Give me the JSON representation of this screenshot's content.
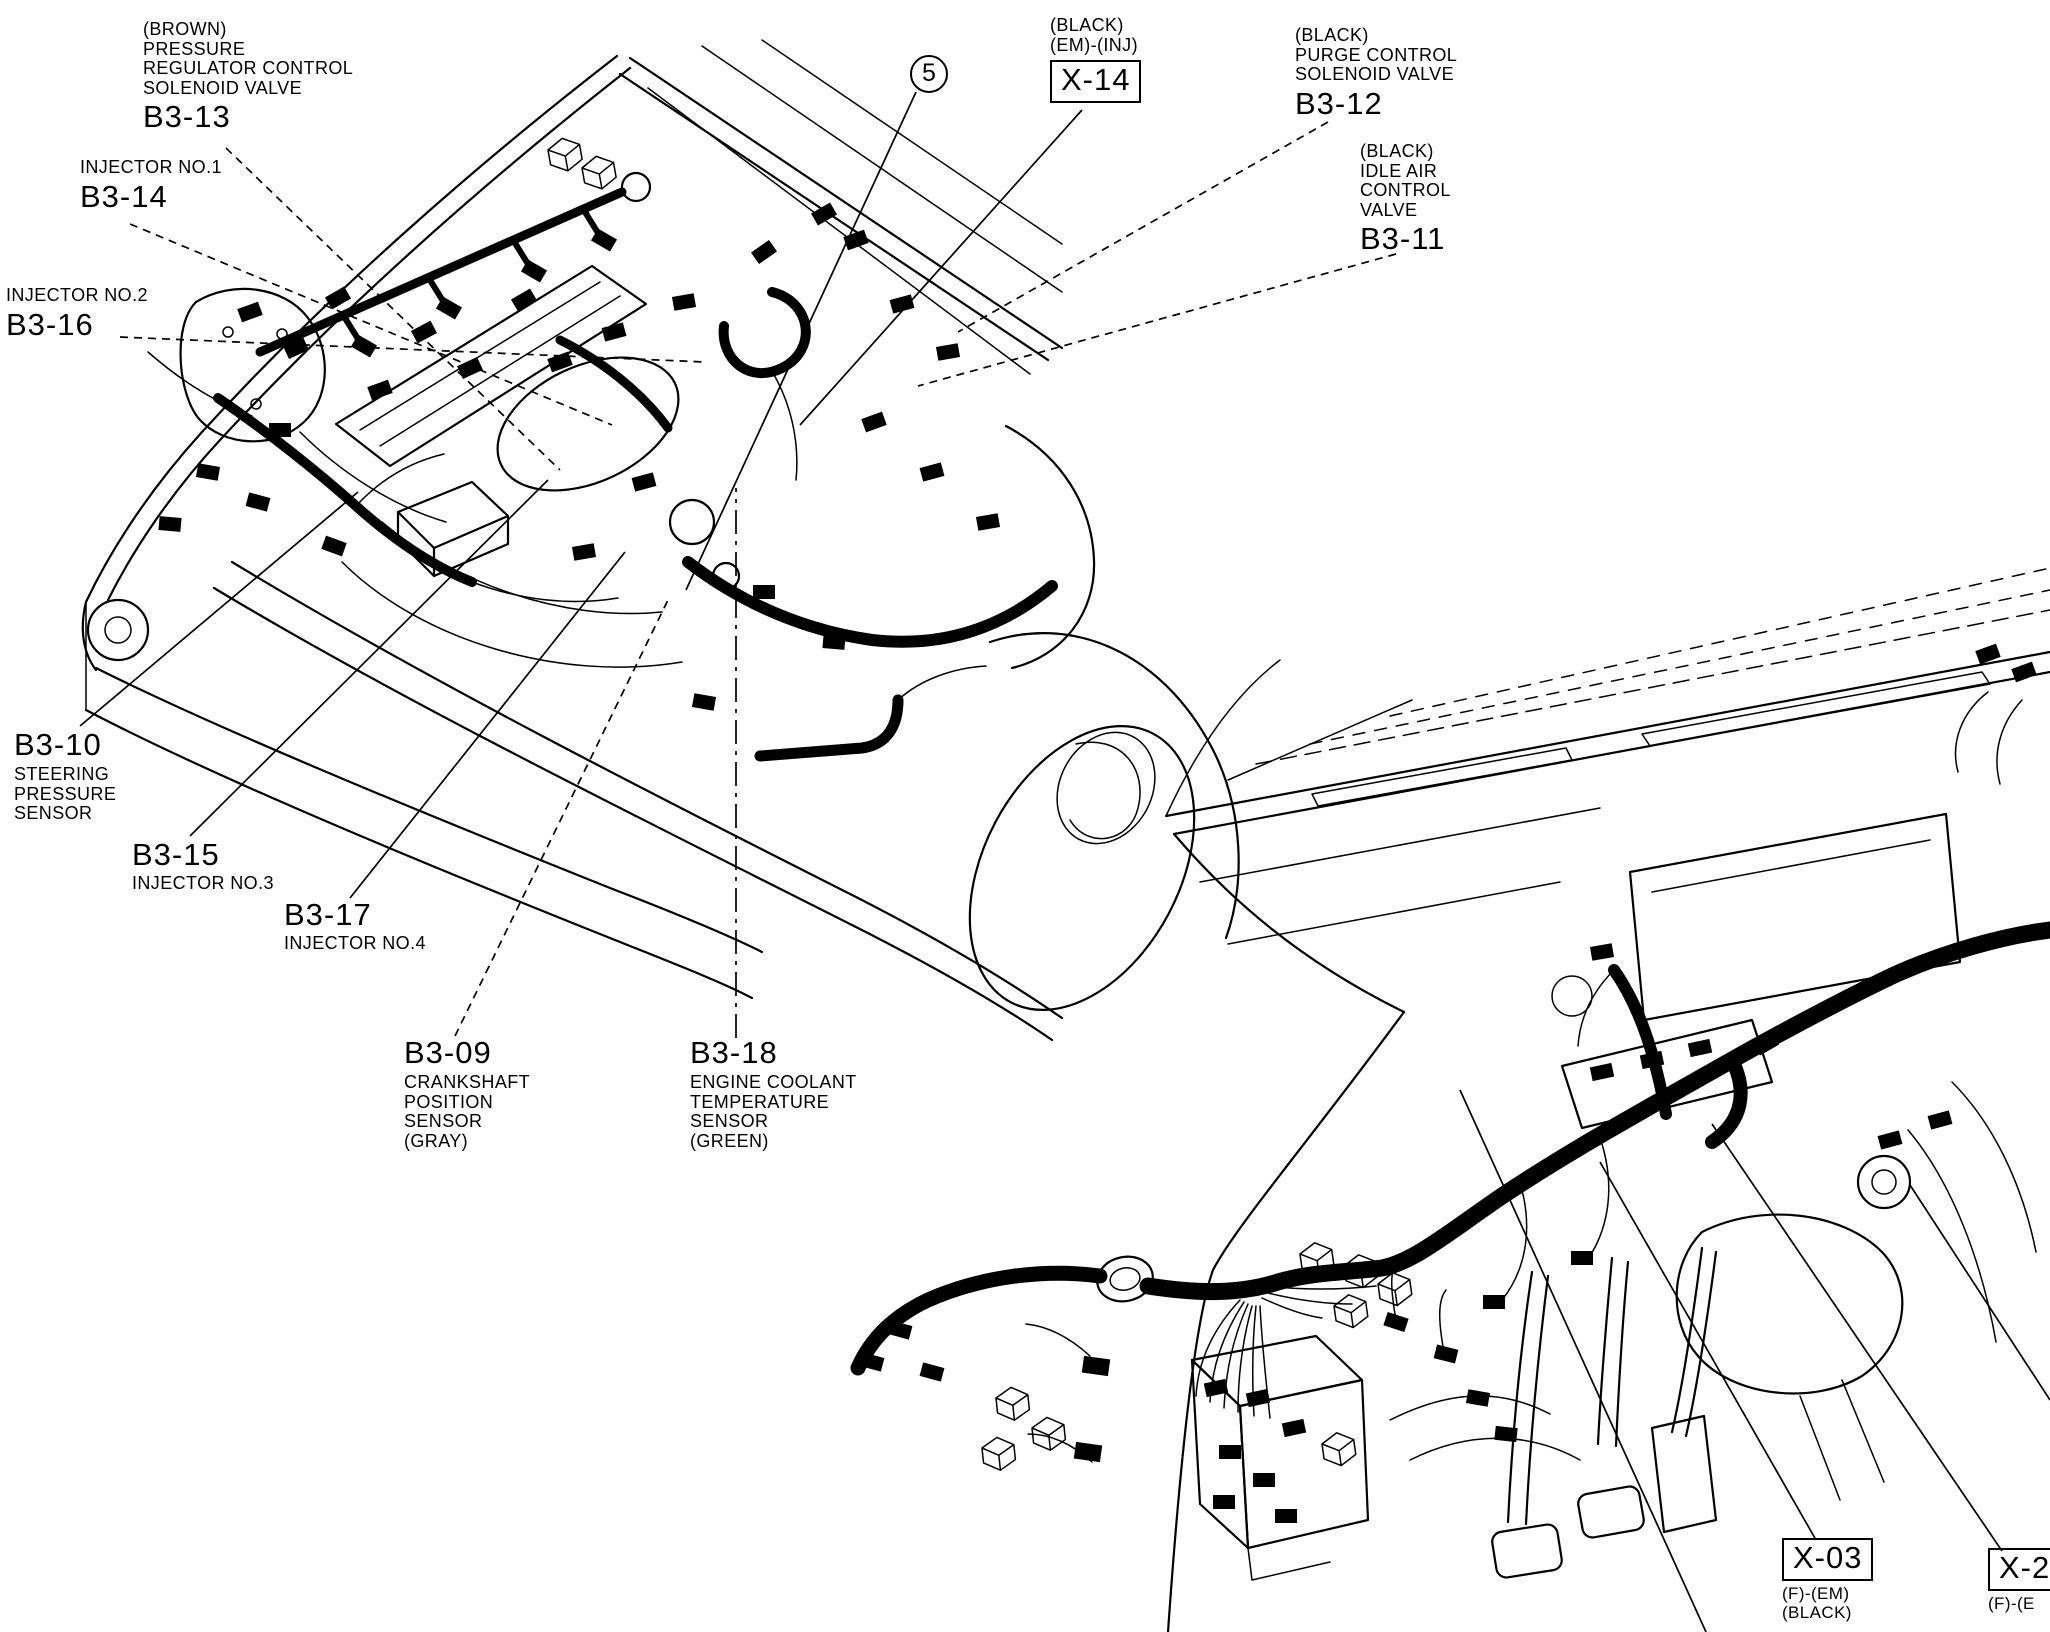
{
  "page": {
    "background_color": "#ffffff",
    "ink_color": "#000000",
    "figure_type": "wiring connector location diagram (engine compartment and dashboard)"
  },
  "callouts": {
    "b3_13": {
      "note_lines": [
        "(BROWN)",
        "PRESSURE",
        "REGULATOR CONTROL",
        "SOLENOID VALVE"
      ],
      "code": "B3-13"
    },
    "b3_14": {
      "note_lines": [
        "INJECTOR NO.1"
      ],
      "code": "B3-14"
    },
    "b3_16": {
      "note_lines": [
        "INJECTOR NO.2"
      ],
      "code": "B3-16"
    },
    "ref_5": {
      "code": "5"
    },
    "x_14": {
      "note_lines": [
        "(BLACK)",
        "(EM)-(INJ)"
      ],
      "code": "X-14"
    },
    "b3_12": {
      "note_lines": [
        "(BLACK)",
        "PURGE CONTROL",
        "SOLENOID VALVE"
      ],
      "code": "B3-12"
    },
    "b3_11": {
      "note_lines": [
        "(BLACK)",
        "IDLE AIR",
        "CONTROL",
        "VALVE"
      ],
      "code": "B3-11"
    },
    "b3_10": {
      "code": "B3-10",
      "note_lines": [
        "STEERING",
        "PRESSURE",
        "SENSOR"
      ]
    },
    "b3_15": {
      "code": "B3-15",
      "note_lines": [
        "INJECTOR NO.3"
      ]
    },
    "b3_17": {
      "code": "B3-17",
      "note_lines": [
        "INJECTOR NO.4"
      ]
    },
    "b3_09": {
      "code": "B3-09",
      "note_lines": [
        "CRANKSHAFT",
        "POSITION",
        "SENSOR",
        "(GRAY)"
      ]
    },
    "b3_18": {
      "code": "B3-18",
      "note_lines": [
        "ENGINE COOLANT",
        "TEMPERATURE",
        "SENSOR",
        "(GREEN)"
      ]
    },
    "x_03": {
      "code": "X-03",
      "note_lines": [
        "(F)-(EM)",
        "(BLACK)"
      ]
    },
    "x_2x": {
      "code": "X-2",
      "note_lines": [
        "(F)-(E"
      ]
    }
  }
}
